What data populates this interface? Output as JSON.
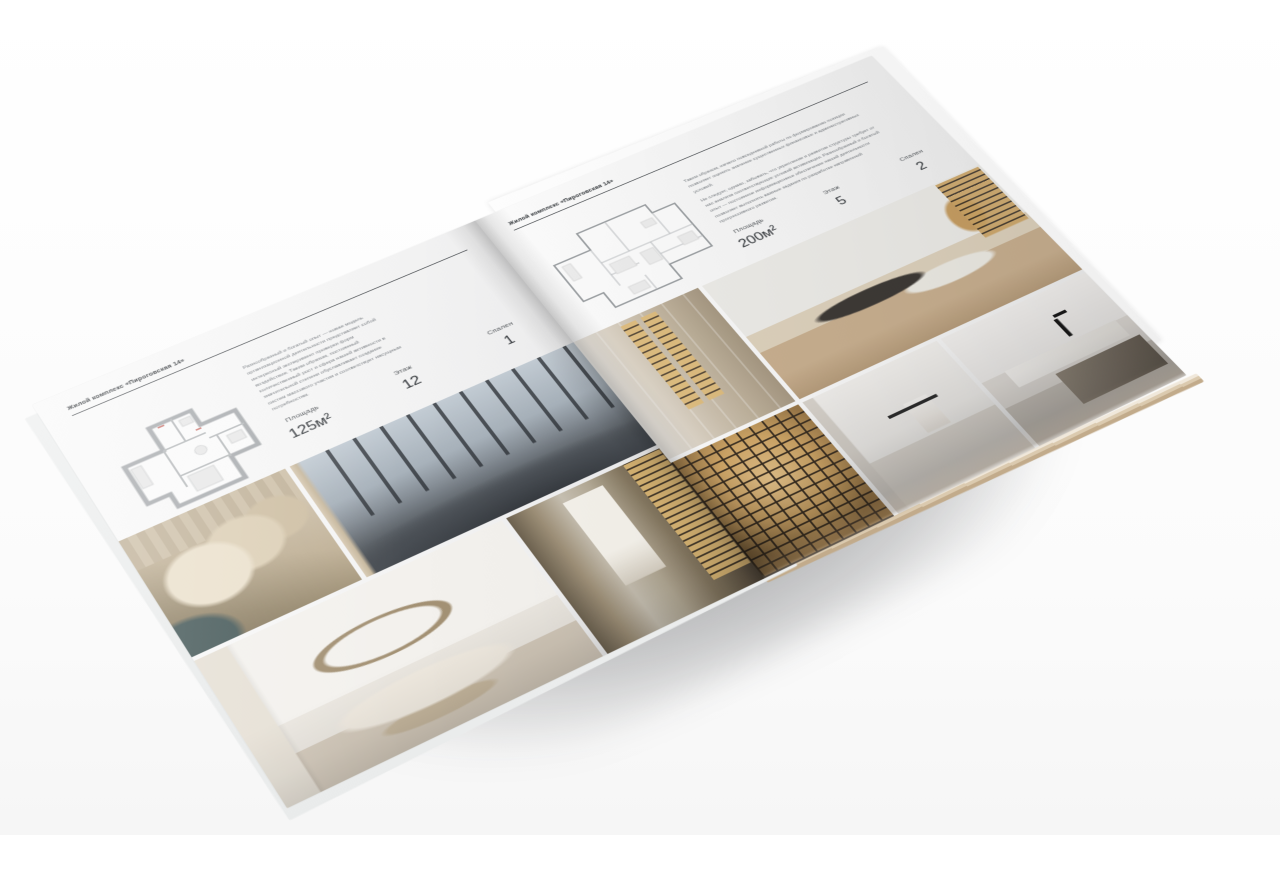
{
  "palette": {
    "paper": "#f6f6f6",
    "ink": "#2f3337",
    "muted_text": "#797e83",
    "plan_wall_gray": "#abaeb1",
    "plan_mark_red": "#c2574f",
    "photo_gold": "#d2a868",
    "photo_charcoal": "#43474c"
  },
  "brochure": {
    "left_page": {
      "header": "Жилой комплекс «Пироговская 14»",
      "description": "Разнообразный и богатый опыт — новая модель организационной деятельности представляет собой интересный эксперимент проверки форм воздействия. Таким образом, постоянный количественный рост и сфера нашей активности в значительной степени обуславливает создание систем массового участия и соответствует насущным потребностям.",
      "stats": [
        {
          "label": "Площадь",
          "value": "125м²"
        },
        {
          "label": "Этаж",
          "value": "12"
        },
        {
          "label": "Спален",
          "value": "1"
        }
      ],
      "floor_plan": "план квартиры 125 м²",
      "photos": {
        "hero": "спальня с панорамными окнами",
        "pillows": "кровать с подушками — деталь",
        "arch": "спальня с декоративной аркой",
        "shelf": "холл с подсвеченным стеллажом"
      }
    },
    "right_page": {
      "header": "Жилой комплекс «Пироговская 14»",
      "description_1": "Таким образом, начало повседневной работы по формированию позиции позволяет оценить значение существенных финансовых и административных условий.",
      "description_2": "Не следует, однако, забывать, что укрепление и развитие структуры требует от нас анализа соответствующих условий активизации. Разнообразный и богатый опыт — постоянное информационное обеспечение нашей деятельности позволяет выполнять важные задания по разработке направлений прогрессивного развития.",
      "stats": [
        {
          "label": "Площадь",
          "value": "200м²"
        },
        {
          "label": "Этаж",
          "value": "5"
        },
        {
          "label": "Спален",
          "value": "2"
        }
      ],
      "floor_plan": "план квартиры 200 м²",
      "photos": {
        "wardrobe": "гардероб с подсвеченными полками",
        "study": "кабинет с письменным столом",
        "shelf_closeup": "стеллаж с подсветкой — деталь",
        "bath": "светлая ванная комната",
        "vanity": "мраморная столешница с чёрным смесителем"
      }
    }
  }
}
